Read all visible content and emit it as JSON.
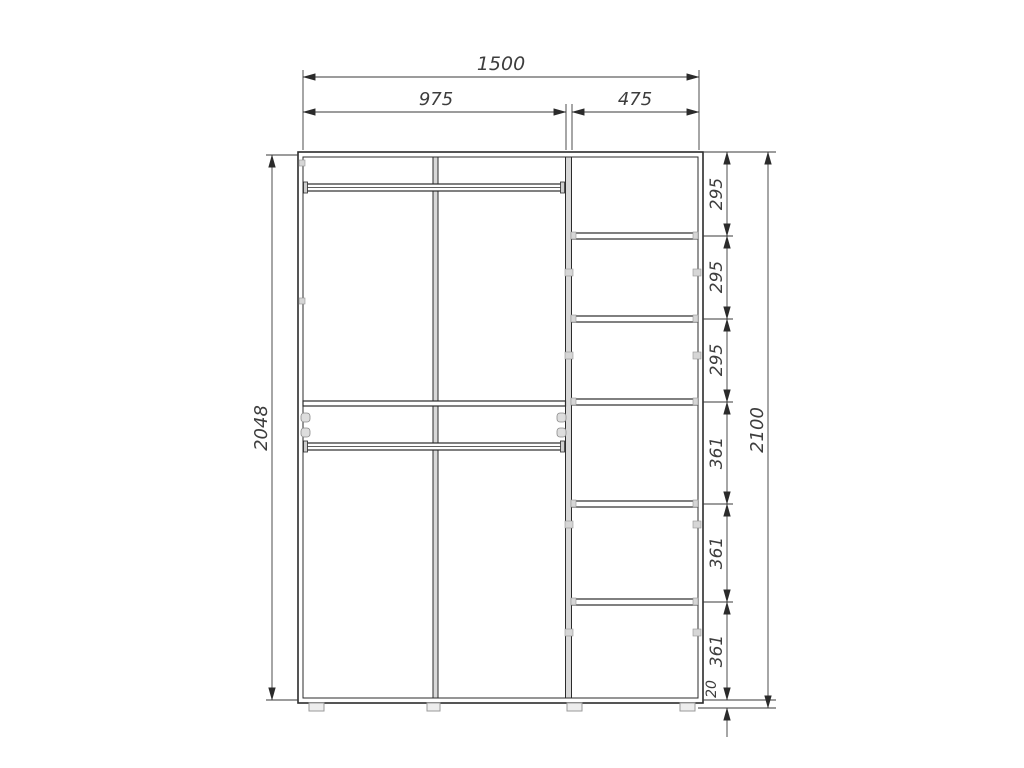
{
  "drawing": {
    "subject": "wardrobe-front-elevation",
    "background": "#ffffff",
    "colors": {
      "object_line": "#2b2b2b",
      "dimension_line": "#3a3a3a",
      "panel_fill": "#d8d8d8",
      "fitting_fill": "#d4d4d4",
      "text": "#3d3d3d"
    },
    "dims": {
      "total_width": "1500",
      "left_section_width": "975",
      "right_section_width": "475",
      "body_height": "2048",
      "total_height": "2100",
      "gaps": [
        "295",
        "295",
        "295",
        "361",
        "361",
        "361"
      ],
      "plinth_height": "20"
    }
  }
}
